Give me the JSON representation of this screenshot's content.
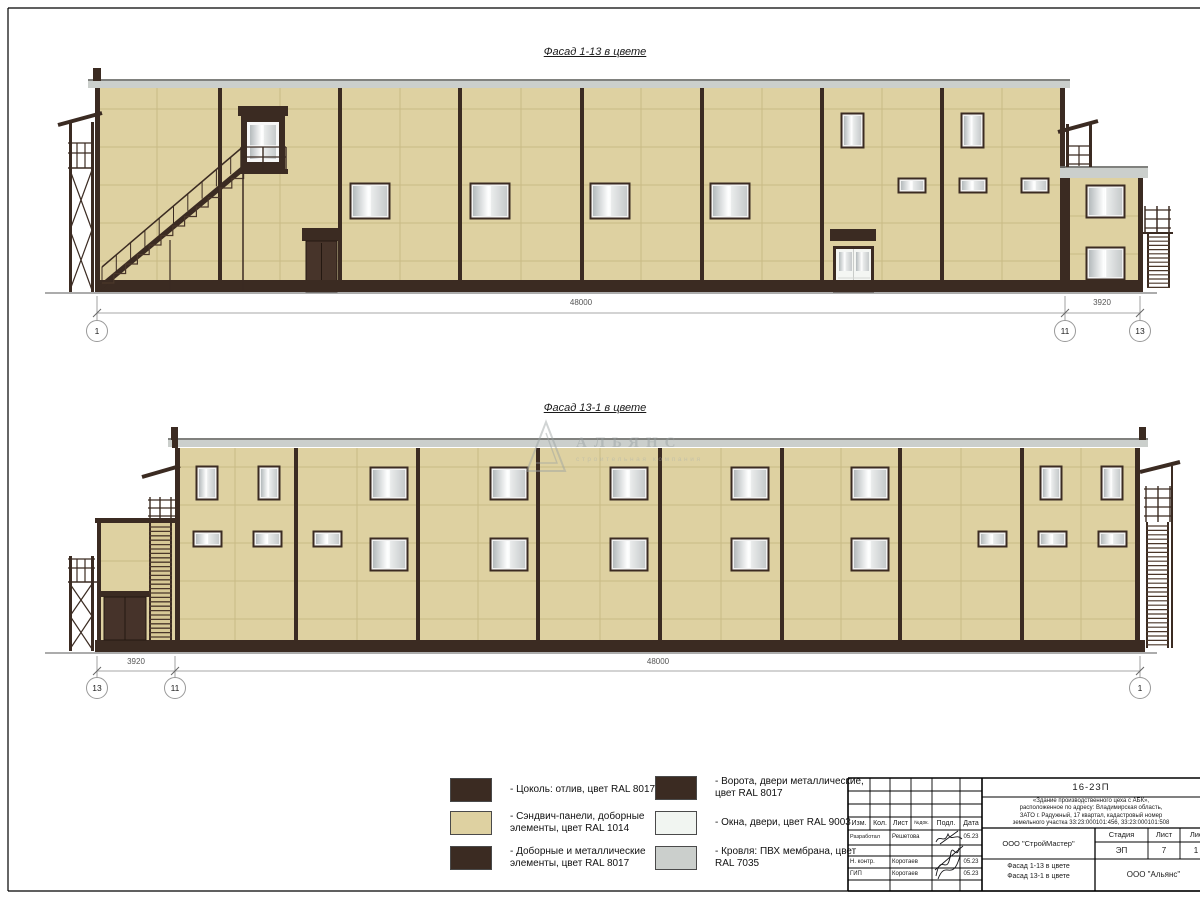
{
  "drawing": {
    "facade_top": {
      "title": "Фасад 1-13 в цвете",
      "dim_main": "48000",
      "dim_side": "3920",
      "axis_left": "1",
      "axis_mid": "11",
      "axis_right": "13"
    },
    "facade_bottom": {
      "title": "Фасад 13-1 в цвете",
      "dim_side": "3920",
      "dim_main": "48000",
      "axis_left": "13",
      "axis_mid": "11",
      "axis_right": "1"
    }
  },
  "colors": {
    "dark_brown": "#3B2B22",
    "beige": "#DED1A1",
    "white": "#F1F5F1",
    "gray": "#CBCFCC"
  },
  "legend": {
    "items": [
      {
        "label": "- Цоколь: отлив, цвет RAL 8017"
      },
      {
        "label": "- Сэндвич-панели, доборные элементы, цвет RAL 1014"
      },
      {
        "label": "- Доборные и металлические элементы, цвет RAL 8017"
      },
      {
        "label": "- Ворота, двери металлические, цвет RAL 8017"
      },
      {
        "label": "- Окна, двери, цвет RAL 9003"
      },
      {
        "label": "- Кровля: ПВХ мембрана, цвет RAL 7035"
      }
    ]
  },
  "title_block": {
    "doc_number": "16-23П",
    "description_lines": [
      "«Здание производственного цеха с АБК»,",
      "расположенное по адресу: Владимирская область,",
      "ЗАТО г. Радужный, 17 квартал, кадастровый номер",
      "земельного участка 33:23:000101:456, 33:23:000101:508"
    ],
    "columns": {
      "izm": "Изм.",
      "kol": "Кол.",
      "list": "Лист",
      "ndok": "№док.",
      "podp": "Подл.",
      "data": "Дата"
    },
    "rows": [
      {
        "role": "Разработал",
        "name": "Решетова",
        "date": "05.23"
      },
      {
        "role": "Н. контр.",
        "name": "Коротаев",
        "date": "05.23"
      },
      {
        "role": "ГИП",
        "name": "Коротаев",
        "date": "05.23"
      }
    ],
    "org_designer": "ООО \"СтройМастер\"",
    "stage_label": "Стадия",
    "sheet_label": "Лист",
    "sheets_label": "Листов",
    "stage_value": "ЭП",
    "sheet_value": "7",
    "sheets_value": "1",
    "subject_line1": "Фасад 1-13 в цвете",
    "subject_line2": "Фасад 13-1 в цвете",
    "org_client": "ООО \"Альянс\""
  },
  "watermark": {
    "name": "АЛЬЯНС",
    "subtitle": "строительная компания"
  }
}
